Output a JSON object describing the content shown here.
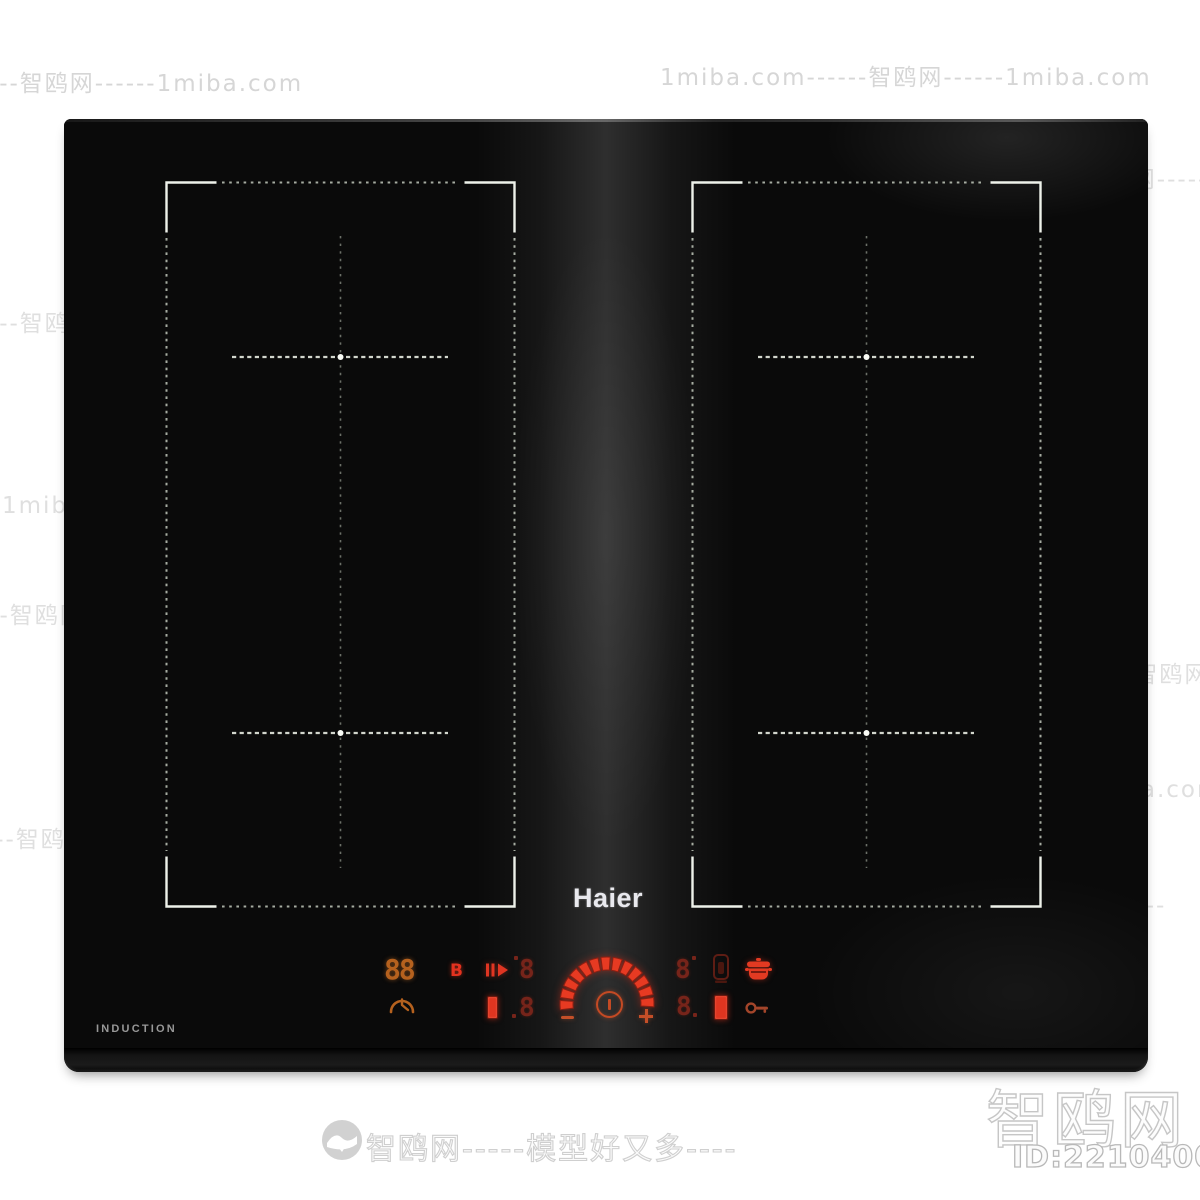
{
  "brand": "Haier",
  "bottom_left_label": "INDUCTION",
  "panel": {
    "heat_display": "88",
    "boost_label": "B",
    "digit_top_left": "8",
    "digit_bottom_left": "8",
    "digit_top_right": "8",
    "digit_bottom_right": "8",
    "minus_label": "−",
    "plus_label": "+"
  },
  "icons": {
    "pause-play-icon": "pause/resume touch key (‖▶)",
    "timer-icon": "timer gauge with clock hand",
    "power-icon": "power ring with vertical bar",
    "probe-icon": "temperature probe / milk function",
    "pot-icon": "cooking pot with lid",
    "key-lock-icon": "child lock key",
    "heat-bar-left": "heat level bar",
    "heat-bar-right": "heat level bar",
    "site-logo-icon": "seagull in circle watermark logo"
  },
  "colors": {
    "led_bright": "#e23a22",
    "led_dim": "#76241a",
    "led_orange": "#b5611e",
    "zone_line": "#d8ddd2",
    "glass": "#0a0a0a"
  },
  "arc": {
    "cx": 607,
    "cy": 1004,
    "r_outer": 47,
    "r_inner": 34,
    "start_deg": 187,
    "end_deg": -7,
    "segments": 13,
    "fill": "#e73a22",
    "stroke": "#8c1f12"
  },
  "footer": {
    "site_name_large": "智鸥网",
    "model_id": "ID:221040016",
    "tagline": "智鸥网-----模型好又多----"
  },
  "watermarks": [
    {
      "t": "------智鸥网------1miba.com",
      "x": -42,
      "y": 64,
      "c": "wm-white"
    },
    {
      "t": "1miba.com------智鸥网------1miba.com",
      "x": 660,
      "y": 58,
      "c": "wm-white"
    },
    {
      "t": "------智鸥网-------",
      "x": 1020,
      "y": 160,
      "c": "wm-mid"
    },
    {
      "t": "智鸥网------",
      "x": 320,
      "y": 166,
      "c": "wm-black"
    },
    {
      "t": "------智鸥网------1miba.com",
      "x": -42,
      "y": 304,
      "c": "wm-mid"
    },
    {
      "t": "1miba.com------智鸥网------1miba.com",
      "x": 658,
      "y": 334,
      "c": "wm-black"
    },
    {
      "t": "-----智鸥网------",
      "x": 314,
      "y": 380,
      "c": "wm-black"
    },
    {
      "t": "------智鸥网------",
      "x": 906,
      "y": 460,
      "c": "wm-mid"
    },
    {
      "t": "1miba.com------智鸥网------1miba.com",
      "x": 2,
      "y": 486,
      "c": "wm-mid"
    },
    {
      "t": "智鸥网------模型好又多-----",
      "x": 720,
      "y": 549,
      "s": 26,
      "c": "wm-mid"
    },
    {
      "t": "------智鸥网------",
      "x": -52,
      "y": 596,
      "c": "wm-mid"
    },
    {
      "t": "1miba.com------智鸥网------",
      "x": 926,
      "y": 655,
      "c": "wm-mid"
    },
    {
      "t": "1miba.com------智鸥网------",
      "x": 98,
      "y": 686,
      "c": "wm-black"
    },
    {
      "t": "1miba.com------智鸥网-----1miba.com",
      "x": 740,
      "y": 770,
      "c": "wm-mid"
    },
    {
      "t": "------智鸥网------",
      "x": -46,
      "y": 820,
      "c": "wm-mid"
    },
    {
      "t": "-----智鸥网------",
      "x": 978,
      "y": 886,
      "c": "wm-mid"
    },
    {
      "t": "----智鸥网-----",
      "x": 220,
      "y": 920,
      "c": "wm-black"
    },
    {
      "t": "-------智鸥网------1miba.com",
      "x": -24,
      "y": 958,
      "c": "wm-black"
    }
  ]
}
